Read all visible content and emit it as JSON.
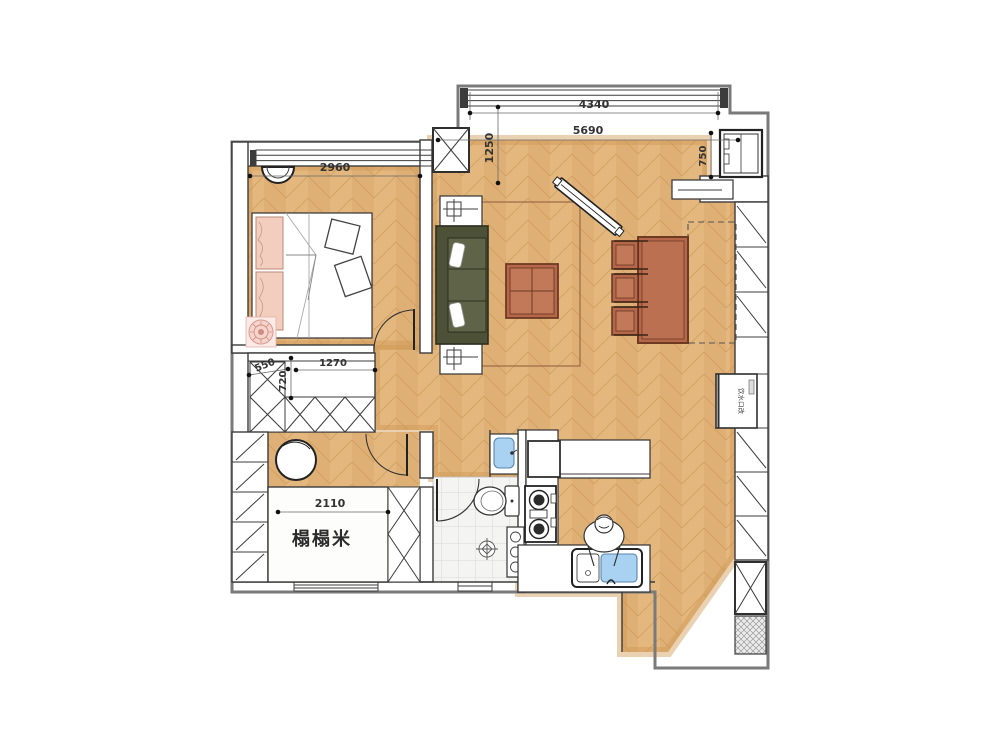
{
  "labels": {
    "tatami_room": "榻榻米",
    "water_note": "饮水口改"
  },
  "dimensions": {
    "bedroom_width": "2960",
    "balcony_window_width": "4340",
    "living_width": "5690",
    "living_entry_depth": "1250",
    "fridge_niche": "750",
    "closet_width": "1270",
    "closet_side": "550",
    "closet_depth": "720",
    "tatami_width": "2110"
  },
  "colors": {
    "wood": "#e3b77e",
    "wood_line": "#c6944f",
    "sofa": "#5f6449",
    "table": "#b4674a",
    "sink_blue": "#a9d2f2",
    "pillow_pink": "#f3cdbd",
    "wall_stroke": "#3c3c3c"
  }
}
